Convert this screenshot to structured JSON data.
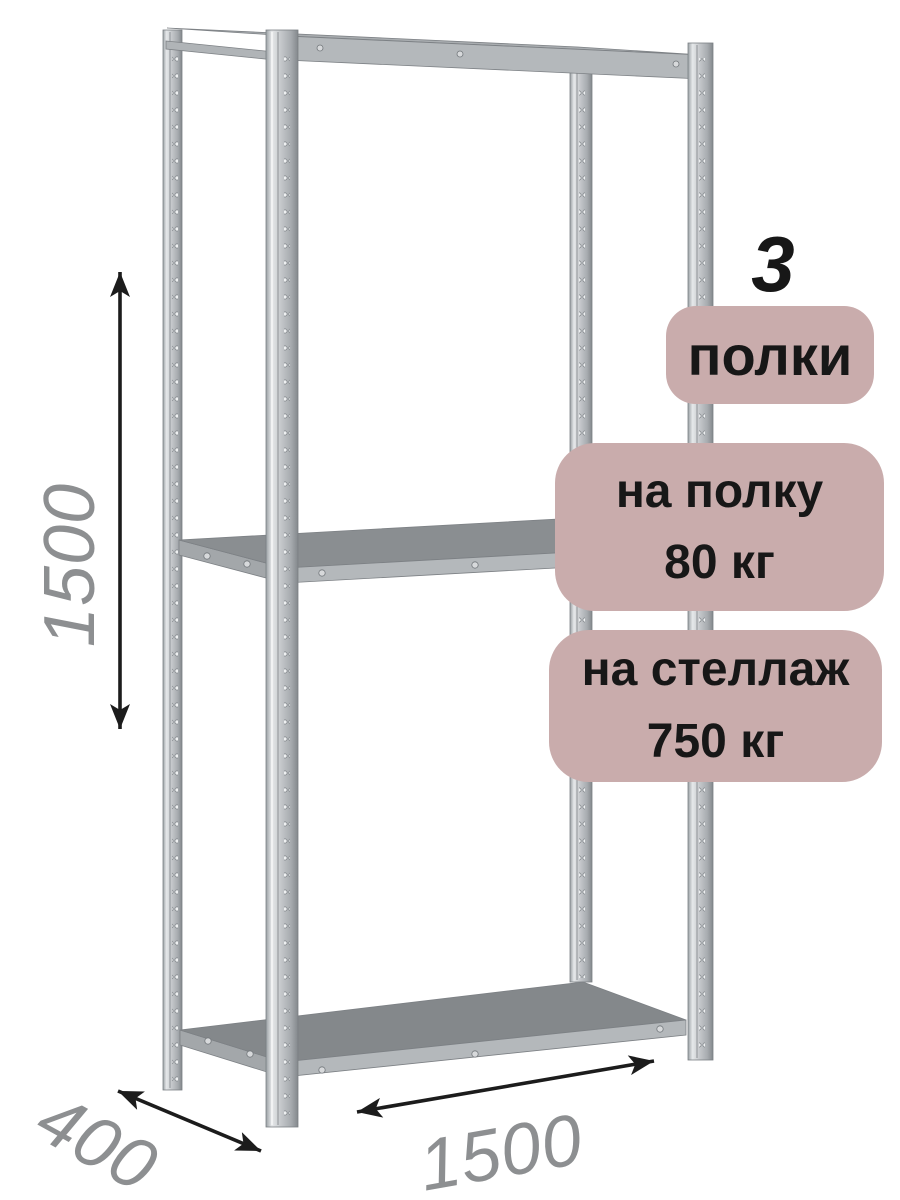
{
  "badges": {
    "shelf_count_number": "3",
    "shelf_count_label": "полки",
    "per_shelf": {
      "line1": "на полку",
      "line2": "80 кг"
    },
    "per_rack": {
      "line1": "на стеллаж",
      "line2": "750 кг"
    }
  },
  "dimensions": {
    "height": "1500",
    "depth": "400",
    "width": "1500"
  },
  "colors": {
    "badge_bg": "#c9acac",
    "badge_text": "#171717",
    "dimension_text": "#8d8f91",
    "arrow": "#1c1c1c",
    "metal_light": "#e6e8ea",
    "metal_mid": "#c6c9cc",
    "metal_dark": "#83888c",
    "shelf_surface": "#84888b",
    "shelf_face": "#b4b8bb"
  }
}
